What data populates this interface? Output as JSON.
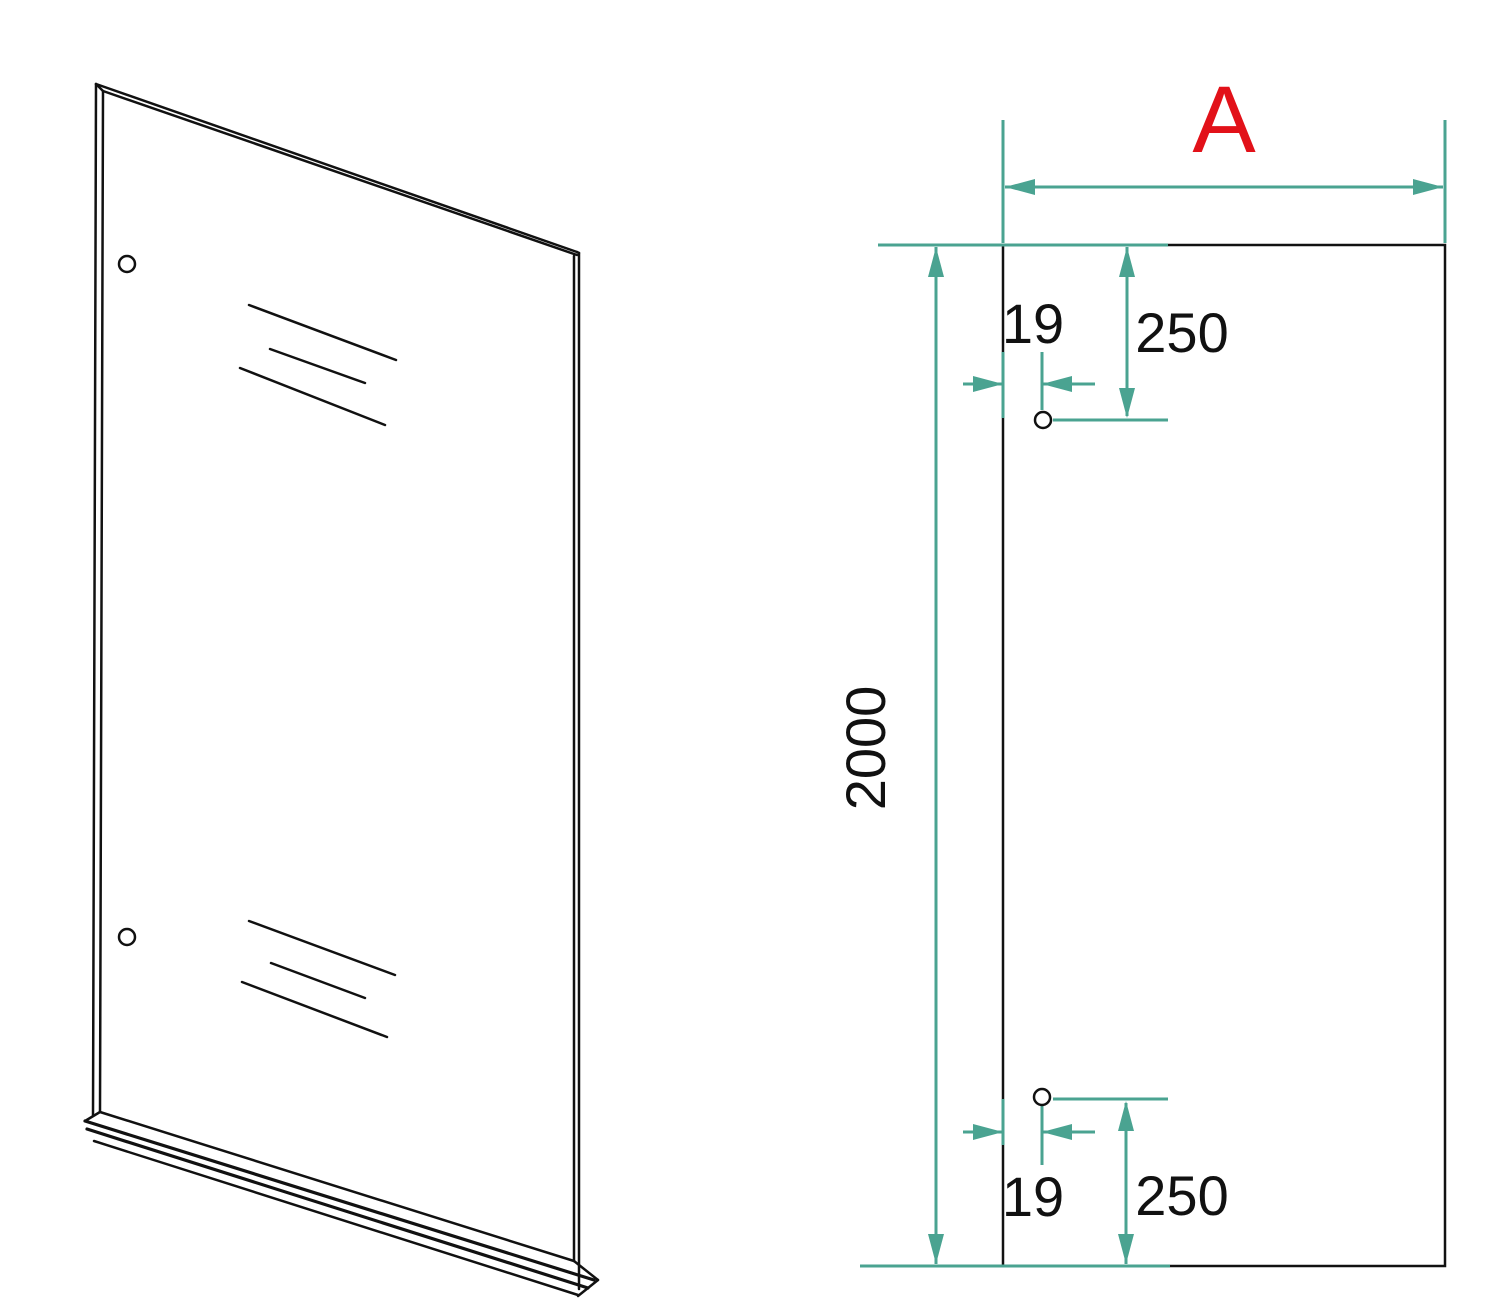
{
  "drawing": {
    "title": "Glass shower panel technical drawing",
    "views": {
      "iso_view": "perspective view of glass panel with bottom seal strip",
      "front_view": "front elevation with hole positions"
    },
    "labels": {
      "panel_width": "A",
      "panel_height": "2000",
      "top_hole_edge_offset": "19",
      "top_hole_top_offset": "250",
      "bottom_hole_edge_offset": "19",
      "bottom_hole_bottom_offset": "250"
    },
    "colors": {
      "dimension_line": "#4aa391",
      "outline": "#111111",
      "width_label_highlight": "#e21119",
      "background": "#ffffff"
    }
  }
}
